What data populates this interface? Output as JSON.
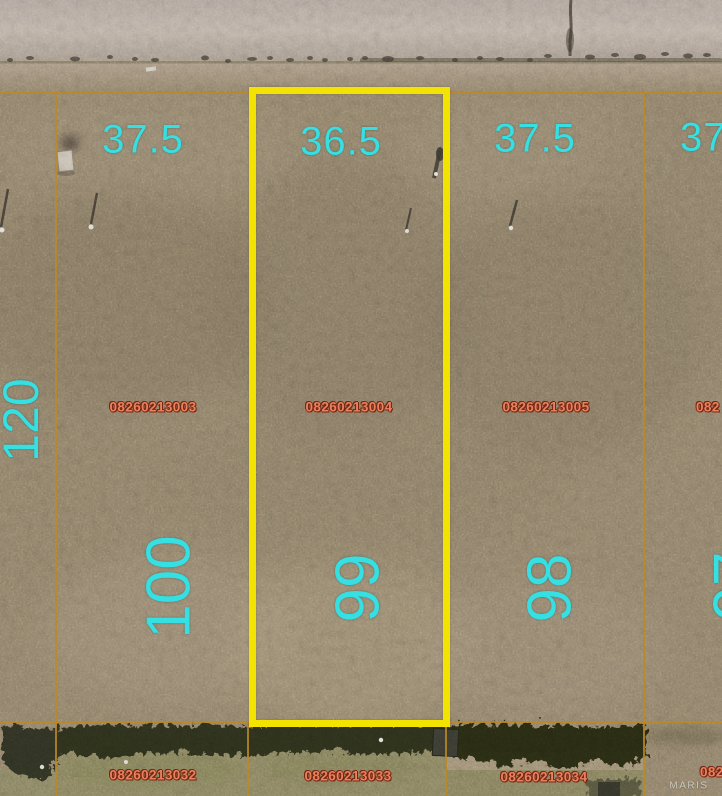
{
  "map_type": "aerial-parcel-plat",
  "watermark": "MARIS",
  "colors": {
    "highlight_border": "#f3e300",
    "parcel_line": "#bc8824",
    "dimension_text": "#35dfe2",
    "parcel_id_fill": "#e8825d",
    "parcel_id_outline": "#782514"
  },
  "selected_parcel_id": "08260213004",
  "lots_front_row": [
    {
      "parcel_id": "08260213003",
      "frontage": "37.5",
      "lot_number": "100",
      "depth": "120",
      "highlighted": false
    },
    {
      "parcel_id": "08260213004",
      "frontage": "36.5",
      "lot_number": "99",
      "highlighted": true
    },
    {
      "parcel_id": "08260213005",
      "frontage": "37.5",
      "lot_number": "98",
      "highlighted": false
    },
    {
      "parcel_id": "082",
      "frontage": "37",
      "lot_number": "97",
      "highlighted": false,
      "partial": true
    }
  ],
  "lots_back_row": [
    {
      "parcel_id": "08260213032"
    },
    {
      "parcel_id": "08260213033"
    },
    {
      "parcel_id": "08260213034"
    },
    {
      "parcel_id": "082",
      "partial": true
    }
  ]
}
